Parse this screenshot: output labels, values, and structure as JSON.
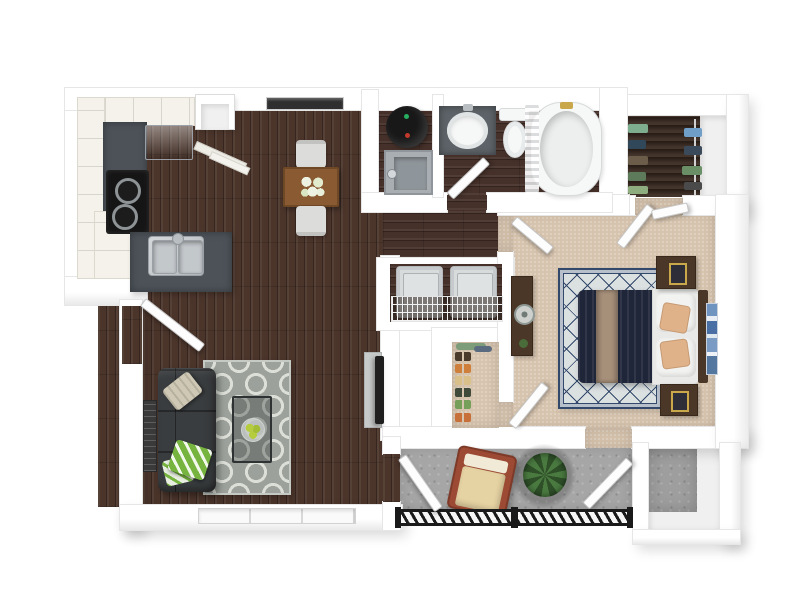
{
  "palette": {
    "page_bg": "#ffffff",
    "wall": "#ffffff",
    "wall_edge": "#e6e6e6",
    "wood": "#4b352b",
    "wood_small": "#46312a",
    "closet_wood": "#3a2a21",
    "carpet": "#d7c4ae",
    "concrete": "#a6a6a6",
    "concrete_shadow": "#8f8f8f",
    "slate": "#4c5258",
    "cream": "#f4f2ea",
    "steel": "#c8ccce",
    "steel_dark": "#9aa0a5",
    "appliance_black": "#151515",
    "sofa": "#3a3d3f",
    "pillow_tan": "#cfc8b4",
    "pillow_green": "#77b43f",
    "rug_living": "#9ca19b",
    "rug_living_line": "#dcdfd7",
    "table_wood": "#8a5a33",
    "chair_gray": "#dcdcda",
    "glass": "#3c4242",
    "fruit_green": "#b5cc3f",
    "tv_black": "#1f1f1f",
    "art_dark": "#3a3a3a",
    "porcelain": "#f6f7f7",
    "vanity_slate": "#5d6368",
    "heater_black": "#181818",
    "pan_gray": "#a9aeb2",
    "washer_gray": "#d8dbdc",
    "rug_bedroom": "#dbe0e1",
    "rug_navy": "#33496b",
    "duvet_navy": "#20263a",
    "throw_tan": "#a6907a",
    "sheet_white": "#e9eae8",
    "bed_pillow_tan": "#e0b28a",
    "furn_wood": "#4a3727",
    "gold": "#c9a84c",
    "art_blue": "#6f94bf",
    "rail_black": "#1a1a1a",
    "chair_frame": "#9c4a33",
    "chair_cushion": "#e6d3a3",
    "plant_dark": "#2e4f28",
    "plant_light": "#4a7a40",
    "window_dark": "#2f2f2f"
  },
  "rooms": [
    {
      "id": "kitchen"
    },
    {
      "id": "dining-area"
    },
    {
      "id": "living-room"
    },
    {
      "id": "entry"
    },
    {
      "id": "bathroom"
    },
    {
      "id": "water-heater-closet"
    },
    {
      "id": "laundry-closet"
    },
    {
      "id": "coat-closet"
    },
    {
      "id": "hallway"
    },
    {
      "id": "bedroom"
    },
    {
      "id": "wardrobe-closet"
    },
    {
      "id": "patio"
    },
    {
      "id": "patio-storage"
    }
  ],
  "furniture": [
    {
      "id": "refrigerator"
    },
    {
      "id": "range-stove"
    },
    {
      "id": "kitchen-sink"
    },
    {
      "id": "pantry-cabinet"
    },
    {
      "id": "dining-table"
    },
    {
      "id": "dining-chair"
    },
    {
      "id": "flower-centerpiece"
    },
    {
      "id": "sofa"
    },
    {
      "id": "throw-pillows"
    },
    {
      "id": "trellis-rug"
    },
    {
      "id": "coffee-table"
    },
    {
      "id": "fruit-bowl"
    },
    {
      "id": "wall-art"
    },
    {
      "id": "television"
    },
    {
      "id": "water-heater"
    },
    {
      "id": "drain-pan"
    },
    {
      "id": "vanity-sink"
    },
    {
      "id": "toilet"
    },
    {
      "id": "bathtub"
    },
    {
      "id": "shower-curtain"
    },
    {
      "id": "washer"
    },
    {
      "id": "dryer"
    },
    {
      "id": "wire-shelf"
    },
    {
      "id": "queen-bed"
    },
    {
      "id": "nightstand"
    },
    {
      "id": "dresser"
    },
    {
      "id": "round-mirror"
    },
    {
      "id": "diamond-rug"
    },
    {
      "id": "blue-wall-art"
    },
    {
      "id": "hanging-clothes"
    },
    {
      "id": "shoe-rack"
    },
    {
      "id": "lounge-chair"
    },
    {
      "id": "potted-plant"
    },
    {
      "id": "balcony-railing"
    }
  ],
  "coat_closet": {
    "shoe_colors": [
      "#4a3a2c",
      "#cf7f3c",
      "#d9c08a",
      "#3f4a3a",
      "#76a05a",
      "#c8703a"
    ],
    "hanging_colors": [
      "#7d9c7a",
      "#5b6b7f"
    ]
  },
  "wardrobe": {
    "clothes_left": [
      "#7fae8f",
      "#31475a",
      "#6b5d4a",
      "#5d7a5a",
      "#8fae7f"
    ],
    "clothes_right": [
      "#6f9ec8",
      "#3a4a5a",
      "#6a8f66",
      "#4a4a4a"
    ]
  }
}
